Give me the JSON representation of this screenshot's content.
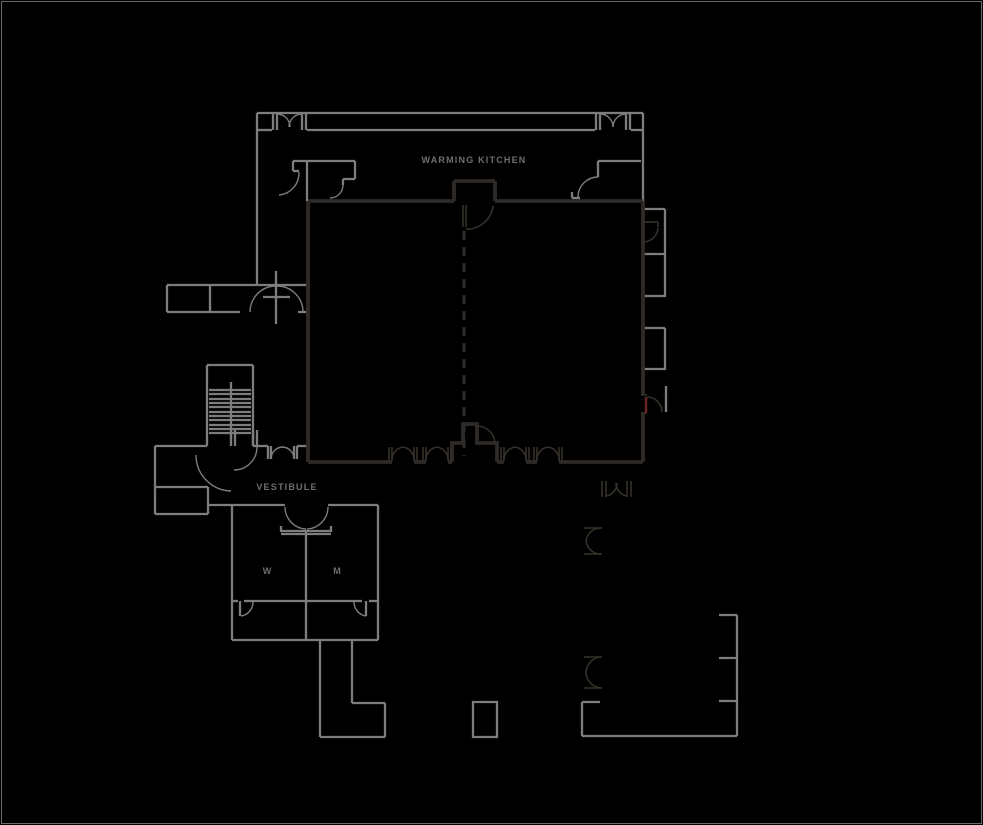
{
  "canvas": {
    "width": 983,
    "height": 825,
    "background": "#000000",
    "frame_color": "#6a6a6a"
  },
  "plan": {
    "label_color": "#6f6f6f",
    "labels": [
      {
        "id": "label-warming-kitchen",
        "text": "WARMING KITCHEN",
        "x": 474,
        "y": 163,
        "size": 9,
        "spacing": 1.2
      },
      {
        "id": "label-vestibule",
        "text": "VESTIBULE",
        "x": 287,
        "y": 490,
        "size": 9,
        "spacing": 1.2
      },
      {
        "id": "label-room-w",
        "text": "W",
        "x": 267,
        "y": 574,
        "size": 9,
        "spacing": 0
      },
      {
        "id": "label-room-m",
        "text": "M",
        "x": 337,
        "y": 574,
        "size": 9,
        "spacing": 0
      }
    ],
    "layers": [
      {
        "id": "walls-light",
        "color": "#7d7d7d",
        "width": 2.3,
        "paths": [
          "M257,113 H643",
          "M257,113 V285",
          "M643,113 V202",
          "M257,130 H272",
          "M307,130 H595",
          "M631,130 H643",
          "M273,113 V130",
          "M277,113 V130",
          "M302,113 V130",
          "M306,113 V130",
          "M596,113 V130",
          "M600,113 V130",
          "M626,113 V130",
          "M630,113 V130",
          "M307,161 V201",
          "M293,161 H355",
          "M293,161 V171",
          "M293,171 H299",
          "M355,161 V179",
          "M343,179 H355",
          "M343,179 V185",
          "M598,161 H641",
          "M598,161 V177",
          "M572,192 V198",
          "M572,198 H580",
          "M644,209 H665",
          "M665,209 V297",
          "M644,254 H665",
          "M644,296 H665",
          "M644,328 H665",
          "M665,328 V370",
          "M644,369 H665",
          "M666,386 V412",
          "M167,285 H307",
          "M167,285 V312",
          "M167,312 H240",
          "M210,285 V312",
          "M298,312 H308",
          "M276,271 V324",
          "M263,297 H290",
          "M207,365 H253",
          "M207,365 V446",
          "M253,365 V446",
          "M231,382 V439",
          "M209,390 H251",
          "M209,394 H251",
          "M209,399 H251",
          "M209,403 H251",
          "M209,407 H251",
          "M209,412 H251",
          "M209,416 H251",
          "M209,420 H251",
          "M209,425 H251",
          "M209,429 H251",
          "M209,433 H251",
          "M231,430 V446",
          "M235,430 V446",
          "M253,430 V446",
          "M257,430 V446",
          "M155,446 H207",
          "M155,446 V514",
          "M155,487 H208",
          "M208,487 V514",
          "M155,514 H208",
          "M208,505 H232",
          "M253,446 H268",
          "M297,446 H308",
          "M268,446 V459",
          "M271,446 V459",
          "M294,446 V459",
          "M297,446 V459",
          "M232,505 H285",
          "M328,505 H378",
          "M232,505 V640",
          "M378,505 V640",
          "M232,640 H378",
          "M281,526 V532",
          "M331,526 V532",
          "M281,531 H331",
          "M281,534 H331",
          "M306,532 V640",
          "M232,601 H238",
          "M244,601 H362",
          "M369,601 H378",
          "M240,601 V616",
          "M366,601 V616",
          "M320,640 V737",
          "M352,640 V703",
          "M352,703 H385",
          "M385,703 V737",
          "M320,737 H385",
          "M473,702 H497 V737 H473 Z",
          "M737,615 V736",
          "M719,615 H737",
          "M719,658 H737",
          "M719,701 H737",
          "M582,736 H737",
          "M582,702 V736",
          "M582,702 H600"
        ]
      },
      {
        "id": "door-arcs-light",
        "color": "#7d7d7d",
        "width": 1.4,
        "paths": [
          "M277,114 A13,13 0 0 1 290,127",
          "M302,114 A13,13 0 0 0 289,127",
          "M600,114 A13,13 0 0 1 613,127",
          "M626,114 A13,13 0 0 0 613,127",
          "M299,172 A22,22 0 0 1 279,195",
          "M343,185 A13,13 0 0 1 330,198",
          "M598,177 A20,20 0 0 0 578,197",
          "M250,312 A26,26 0 0 1 276,286",
          "M303,312 A26,26 0 0 0 277,286",
          "M196,455 A36,36 0 0 0 231,491",
          "M257,447 A23,23 0 0 1 234,470",
          "M271,459 A12,12 0 0 1 283,447",
          "M294,459 A12,12 0 0 0 282,447",
          "M285,507 A22,22 0 0 0 306,529",
          "M328,507 A22,22 0 0 1 307,529",
          "M241,616 A14,14 0 0 0 253,602",
          "M366,616 A14,14 0 0 1 354,602"
        ]
      },
      {
        "id": "walls-dark",
        "color": "#2e2a27",
        "width": 3.8,
        "paths": [
          "M308,201 H454",
          "M495,201 H643",
          "M308,201 V462",
          "M643,201 V395",
          "M643,413 V462",
          "M454,201 V181",
          "M454,181 H495",
          "M495,181 V201",
          "M308,462 H392",
          "M414,462 H426",
          "M448,462 H452",
          "M452,462 V443 H463 V424 H477 V443 H497 V462",
          "M497,462 H504",
          "M526,462 H537",
          "M559,462 H643"
        ]
      },
      {
        "id": "symbols-dark",
        "color": "#353029",
        "width": 1.6,
        "paths": [
          "M389,447 V461",
          "M392,447 V461",
          "M414,447 V461",
          "M417,447 V461",
          "M423,447 V461",
          "M426,447 V461",
          "M448,447 V461",
          "M451,447 V461",
          "M501,447 V461",
          "M504,447 V461",
          "M526,447 V461",
          "M529,447 V461",
          "M534,447 V461",
          "M537,447 V461",
          "M559,447 V461",
          "M562,447 V461",
          "M392,461 A13,13 0 0 1 403,447",
          "M414,461 A13,13 0 0 0 403,447",
          "M426,461 A13,13 0 0 1 437,447",
          "M448,461 A13,13 0 0 0 437,447",
          "M504,461 A13,13 0 0 1 515,447",
          "M526,461 A13,13 0 0 0 515,447",
          "M537,461 A13,13 0 0 1 548,447",
          "M559,461 A13,13 0 0 0 548,447",
          "M463,205 V227",
          "M466,205 V227",
          "M493,206 A26,26 0 0 1 466,229",
          "M477,426 A18,18 0 0 1 495,443",
          "M643,222 H658",
          "M658,222 V227",
          "M658,228 A15,15 0 0 1 643,242",
          "M641,395 H647",
          "M641,413 H647",
          "M647,397 A15,15 0 0 1 662,412",
          "M602,481 V497",
          "M606,481 V497",
          "M627,481 V497",
          "M631,481 V497",
          "M606,496 A13,13 0 0 0 617,483",
          "M627,496 A13,13 0 0 1 616,483",
          "M584,528 H602",
          "M584,554 H602",
          "M602,528 A15,15 0 0 0 586,541",
          "M602,554 A15,15 0 0 1 586,541",
          "M584,657 H602",
          "M584,688 H602",
          "M602,657 A16,16 0 0 0 586,672",
          "M602,688 A16,16 0 0 1 586,672"
        ]
      },
      {
        "id": "door-red",
        "color": "#6d2424",
        "width": 2.4,
        "paths": [
          "M646,397 V413"
        ]
      },
      {
        "id": "divider-dashed",
        "color": "#302c2a",
        "width": 3,
        "dash": "9 7",
        "paths": [
          "M464,231 V456"
        ]
      }
    ]
  }
}
